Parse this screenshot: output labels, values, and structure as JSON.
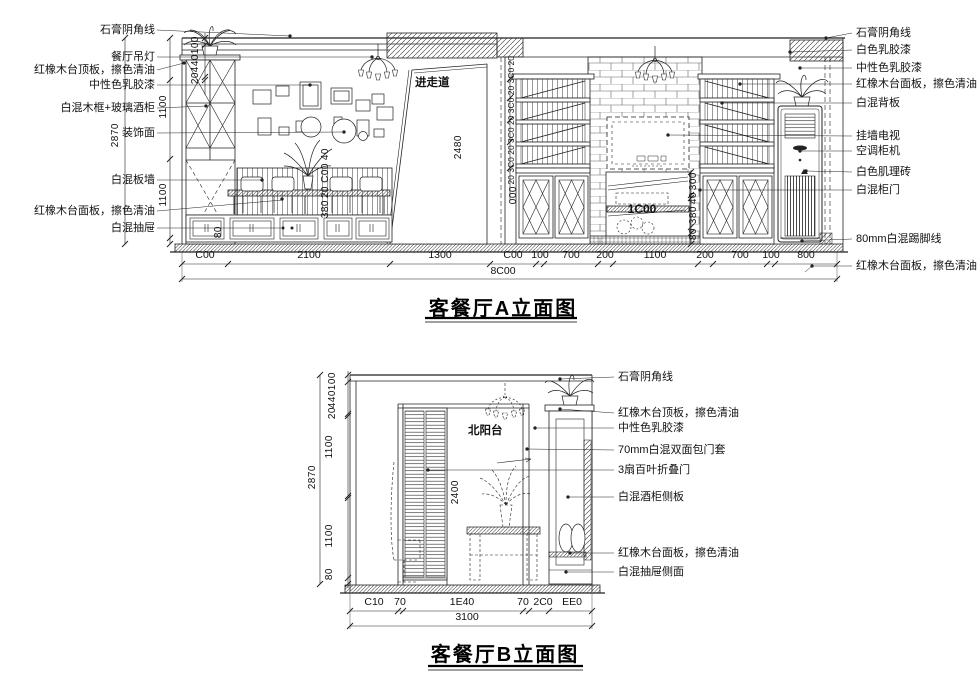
{
  "page": {
    "paper_color": "#ffffff",
    "ink_color": "#1c1c1c"
  },
  "drawing_a": {
    "title": "客餐厅A立面图",
    "room_label": "进走道",
    "labels_left": [
      "石膏阴角线",
      "餐厅吊灯",
      "红橡木台顶板，擦色清油",
      "中性色乳胶漆",
      "白混木框+玻璃酒柜",
      "装饰面",
      "白混板墙",
      "红橡木台面板，擦色清油",
      "白混抽屉"
    ],
    "labels_right": [
      "石膏阴角线",
      "白色乳胶漆",
      "中性色乳胶漆",
      "红橡木台面板，擦色清油",
      "白混背板",
      "挂墙电视",
      "空调柜机",
      "白色肌理砖",
      "白混柜门",
      "80mm白混踢脚线",
      "红橡木台面板，擦色清油"
    ],
    "dims_bottom": [
      "C00",
      "2100",
      "1300",
      "C00",
      "100",
      "700",
      "200",
      "1100",
      "200",
      "700",
      "100",
      "800"
    ],
    "dim_total": "8C00",
    "dims_left": [
      "100",
      "440",
      "20",
      "1100",
      "1100",
      "80"
    ],
    "dim_left_total": "2870",
    "dims_inner_left": [
      "40",
      "C00",
      "20",
      "380"
    ],
    "dims_shelf": "20 3C0 20 3C0 20 3C0 20 3C0 20",
    "dim_shelf_bottom": "000",
    "dims_tv": [
      "300",
      "40",
      "380",
      "80"
    ],
    "dim_tv_width": "1C00",
    "dim_passage": "2480"
  },
  "drawing_b": {
    "title": "客餐厅B立面图",
    "room_label": "北阳台",
    "labels_right": [
      "石膏阴角线",
      "红橡木台顶板，擦色清油",
      "中性色乳胶漆",
      "70mm白混双面包门套",
      "3扇百叶折叠门",
      "白混酒柜侧板",
      "红橡木台面板，擦色清油",
      "白混抽屉侧面"
    ],
    "dims_bottom": [
      "C10",
      "70",
      "1E40",
      "70",
      "2C0",
      "EE0"
    ],
    "dim_total": "3100",
    "dims_left": [
      "100",
      "440",
      "20",
      "1100",
      "1100",
      "80"
    ],
    "dim_left_total": "2870",
    "dim_opening": "2400"
  }
}
